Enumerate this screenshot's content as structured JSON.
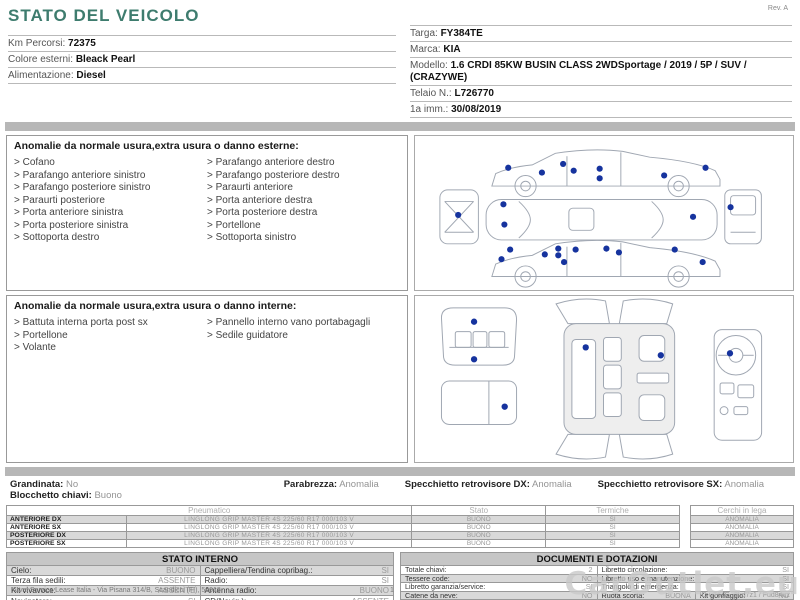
{
  "header": {
    "title": "STATO DEL VEICOLO",
    "rev": "Rev. A",
    "left_fields": [
      {
        "label": "Km Percorsi:",
        "value": "72375"
      },
      {
        "label": "Colore esterni:",
        "value": "Bleack Pearl"
      },
      {
        "label": "Alimentazione:",
        "value": "Diesel"
      }
    ],
    "right_fields": [
      {
        "label": "Targa:",
        "value": "FY384TE"
      },
      {
        "label": "Marca:",
        "value": "KIA"
      },
      {
        "label": "Modello:",
        "value": "1.6 CRDI 85KW BUSIN CLASS 2WDSportage / 2019 / 5P / SUV / (CRAZYWE)"
      },
      {
        "label": "Telaio N.:",
        "value": "L726770"
      },
      {
        "label": "1a imm.:",
        "value": "30/08/2019"
      }
    ]
  },
  "exterior": {
    "title": "Anomalie da normale usura,extra usura o danno esterne:",
    "col1": [
      "Cofano",
      "Parafango anteriore sinistro",
      "Parafango posteriore sinistro",
      "Paraurti posteriore",
      "Porta anteriore sinistra",
      "Porta posteriore sinistra",
      "Sottoporta destro"
    ],
    "col2": [
      "Parafango anteriore destro",
      "Parafango posteriore destro",
      "Paraurti anteriore",
      "Porta anteriore destra",
      "Porta posteriore destra",
      "Portellone",
      "Sottoporta sinistro"
    ]
  },
  "interior": {
    "title": "Anomalie da normale usura,extra usura o danno interne:",
    "col1": [
      "Battuta interna porta post sx",
      "Portellone",
      "Volante"
    ],
    "col2": [
      "Pannello interno vano portabagagli",
      "Sedile guidatore"
    ]
  },
  "condition": {
    "row1": [
      {
        "label": "Grandinata:",
        "value": "No"
      },
      {
        "label": "Parabrezza:",
        "value": "Anomalia"
      },
      {
        "label": "Specchietto retrovisore DX:",
        "value": "Anomalia"
      },
      {
        "label": "Specchietto retrovisore SX:",
        "value": "Anomalia"
      }
    ],
    "row2": {
      "label": "Blocchetto chiavi:",
      "value": "Buono"
    }
  },
  "tires": {
    "col_pneumatico": "Pneumatico",
    "col_stato": "Stato",
    "col_termiche": "Termiche",
    "col_cerchi": "Cerchi in lega",
    "rows": [
      {
        "pos": "ANTERIORE DX",
        "desc": "LINGLONG  GRIP MASTER 4S 225/60 R17 000/103 V",
        "stato": "BUONO",
        "termiche": "SI",
        "cerchi": "ANOMALIA"
      },
      {
        "pos": "ANTERIORE SX",
        "desc": "LINGLONG  GRIP MASTER 4S 225/60 R17 000/103 V",
        "stato": "BUONO",
        "termiche": "SI",
        "cerchi": "ANOMALIA"
      },
      {
        "pos": "POSTERIORE DX",
        "desc": "LINGLONG  GRIP MASTER 4S 225/60 R17 000/103 V",
        "stato": "BUONO",
        "termiche": "SI",
        "cerchi": "ANOMALIA"
      },
      {
        "pos": "POSTERIORE SX",
        "desc": "LINGLONG  GRIP MASTER 4S 225/60 R17 000/103 V",
        "stato": "BUONO",
        "termiche": "SI",
        "cerchi": "ANOMALIA"
      }
    ]
  },
  "stato_interno": {
    "title": "STATO INTERNO",
    "rows": [
      {
        "ll": "Cielo:",
        "lv": "BUONO",
        "rl": "Cappelliera/Tendina copribag.:",
        "rv": "SI"
      },
      {
        "ll": "Terza fila sedili:",
        "lv": "ASSENTE",
        "rl": "Radio:",
        "rv": "SI"
      },
      {
        "ll": "Kit vivavoce:",
        "lv": "ASSENTE",
        "rl": "Antenna radio:",
        "rv": "BUONO"
      },
      {
        "ll": "Navigatore:",
        "lv": "SI",
        "rl": "CD(Navig.):",
        "rv": "ASSENTE"
      }
    ]
  },
  "documenti": {
    "title": "DOCUMENTI E DOTAZIONI",
    "rows": [
      {
        "ll": "Totale chiavi:",
        "lv": "2",
        "rl": "Libretto circolazione:",
        "rv": "SI"
      },
      {
        "ll": "Tessere code:",
        "lv": "NO",
        "rl": "Libretto uso e manutenzione:",
        "rv": "SI"
      },
      {
        "ll": "Libretto garanzia/service:",
        "lv": "SI",
        "rl": "Triangolo di emergenza:",
        "rv": "SI"
      },
      {
        "ll": "Catene da neve:",
        "lv": "NO",
        "rl": "Ruota scorta:",
        "rv": "BUONA",
        "rl2": "Kit gonfiaggio:",
        "rv2": "NO"
      },
      {
        "ll": "Codice autoradio:",
        "lv": "NO",
        "rl": "Cavo elettrico:",
        "rv": ""
      }
    ]
  },
  "footer": {
    "company": "Arval Service Lease Italia - Via Pisana 314/B, Scandicci (FI), 50018",
    "page": "1",
    "doc_id": "ID-uT6JG, 2ud7z1 / Fud84uz"
  },
  "watermark": "CarOutlet.eu",
  "colors": {
    "accent_teal": "#3e7c6e",
    "damage_dot": "#16339e",
    "row_shade": "#d9d9d9",
    "separator_bar": "#b7b7b7"
  }
}
